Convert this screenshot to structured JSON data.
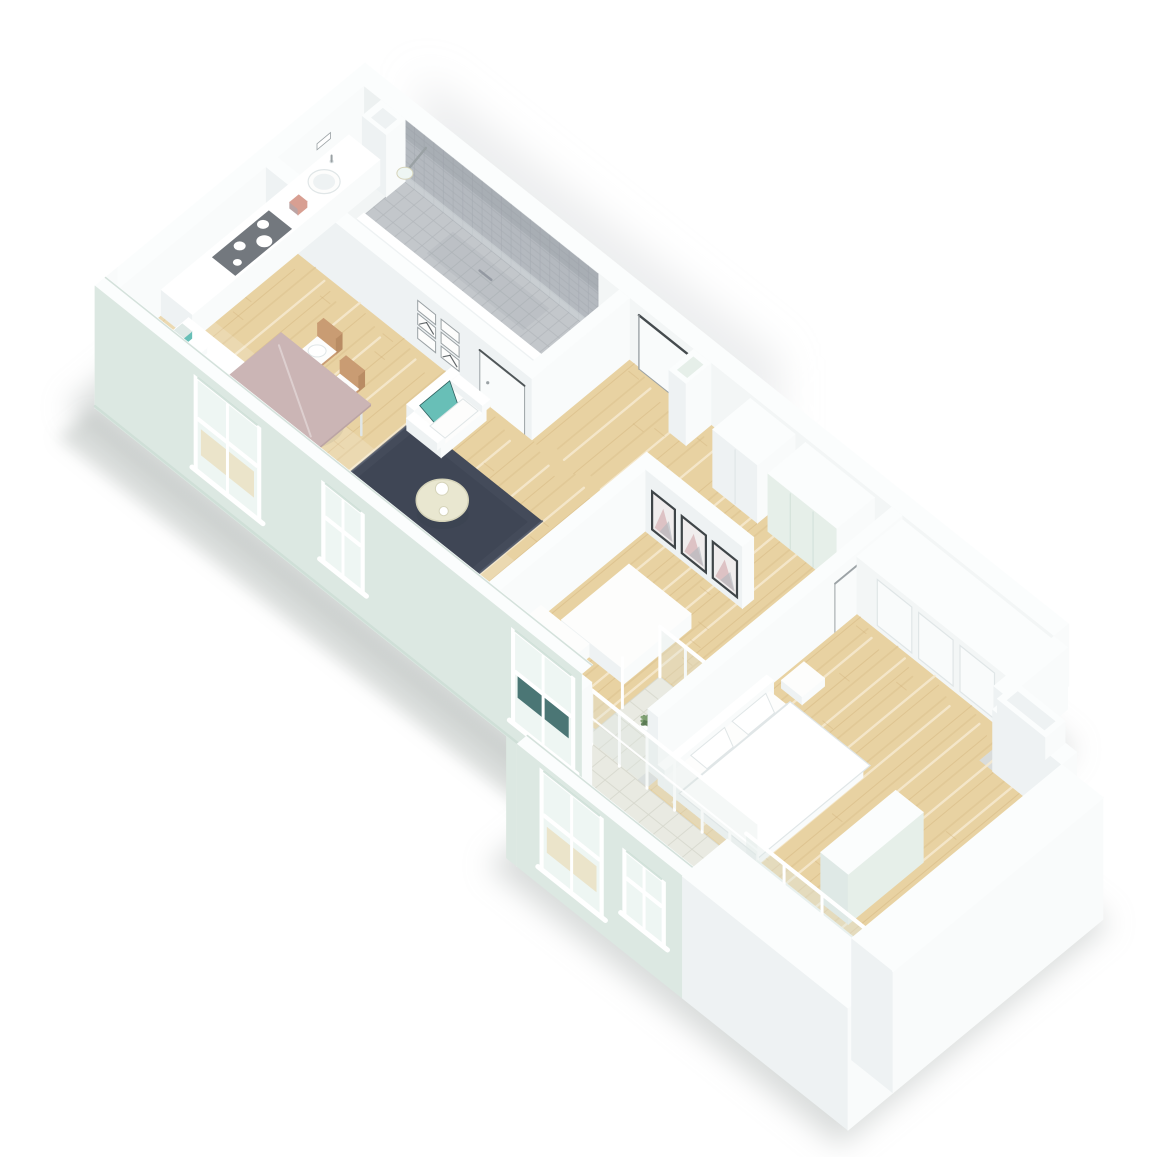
{
  "palette": {
    "bg": "#ffffff",
    "shadow": "#b3bab8",
    "shadow2": "#9aa3a0",
    "ambient": "#d9dcdd",
    "wall_top": "#fbfdfd",
    "wall_bright": "#f9fbfb",
    "wall_shade": "#eef2f3",
    "wall_int": "#f3f6f6",
    "wall_int_dark": "#e7ebec",
    "mint": "#dce8e2",
    "mint_dark": "#c9dcd3",
    "mint_lip": "#cfded7",
    "wood": "#e8d2a2",
    "wood_dark": "#cfae79",
    "wood_mid": "#dcc08d",
    "wood_light": "#f6ead0",
    "bath_floor": "#f2f5f5",
    "tile_wall": "#b4b9bf",
    "tile_wall_line": "#a6abb2",
    "tile_wall_shade": "#8f959d",
    "tile_floor": "#c3c7cb",
    "tile_line": "#b2b6bb",
    "pale_tile": "#e9eae2",
    "pale_tile_line": "#d6d7cc",
    "rug": "#444b5a",
    "rug_dark": "#3a4150",
    "rug_light": "#5a6172",
    "teal": "#68bfb7",
    "teal_dark": "#2e5f5e",
    "mauve": "#cbb5b5",
    "mauve_side": "#bba4a4",
    "chair_wood": "#c99c73",
    "chair_wood_dark": "#b98c64",
    "cream": "#e9e7d0",
    "cream_dark": "#d6d4ba",
    "cooktop": "#73787e",
    "white": "#ffffff",
    "soft_white": "#fdfdfc",
    "door_dark": "#454b4e",
    "line_gray": "#9aa1a4",
    "frame_dark": "#3f4548",
    "art_pink": "#d8b6b9",
    "art_gray": "#b6bac0",
    "art_bg": "#f0eded",
    "glass": "#dfe9e6",
    "glass_bright": "#eef6f3",
    "plant": "#6f8d66",
    "plant_dark": "#597a52",
    "plant_light": "#7fa071",
    "closet_mint": "#e6efe9",
    "closet_seam": "#d5e2db",
    "seam": "#e0e6e7",
    "salmon": "#d89f92"
  },
  "scene": {
    "type": "isometric-3d-floor-plan",
    "style": "white architectural cutaway render, viewed from above at an angle, long narrow apartment running top-left to bottom-right",
    "rooms": [
      {
        "name": "bathroom",
        "floor": "white with gray mosaic shower strip",
        "features": [
          "walk-in shower with gray tiled wall and floor",
          "rain shower head on wall",
          "mini picture frames on hallway-side wall",
          "bathroom door"
        ]
      },
      {
        "name": "kitchen-dining",
        "floor": "light wood planks",
        "features": [
          "L-shaped white counter",
          "dark gray cooktop with four white burners",
          "round white sink with faucet",
          "dining table with dusty-mauve top",
          "two wooden chairs with white cushions"
        ]
      },
      {
        "name": "living-area",
        "floor": "light wood planks",
        "features": [
          "dark navy area rug",
          "white armchair with teal cushion",
          "round cream coffee table with two white spheres"
        ]
      },
      {
        "name": "hallway-entrance",
        "floor": "light wood planks",
        "features": [
          "entrance door with dark frame on upper wall",
          "freestanding square white column",
          "corridor to bedrooms"
        ]
      },
      {
        "name": "bedroom-1",
        "floor": "light wood planks",
        "features": [
          "three framed abstract prints in pink and gray",
          "white closet",
          "mint-front wardrobe",
          "white bed block"
        ]
      },
      {
        "name": "bedroom-2",
        "floor": "light wood planks",
        "features": [
          "double bed with white bedding and two pillows",
          "white nightstand",
          "closet wall with recessed panels",
          "white trough on wall top"
        ]
      },
      {
        "name": "winter-garden",
        "floor": "pale checkered tiles",
        "features": [
          "floor-to-ceiling white-framed glazing",
          "green potted plants",
          "thick white corner walls",
          "low glazed ledge"
        ]
      }
    ],
    "exterior": {
      "wall_finish": "mint-tinted exterior walls with white window frames",
      "windows_front_wall": 5,
      "shadow": "soft gray drop shadow around the lower-left of the building"
    }
  }
}
